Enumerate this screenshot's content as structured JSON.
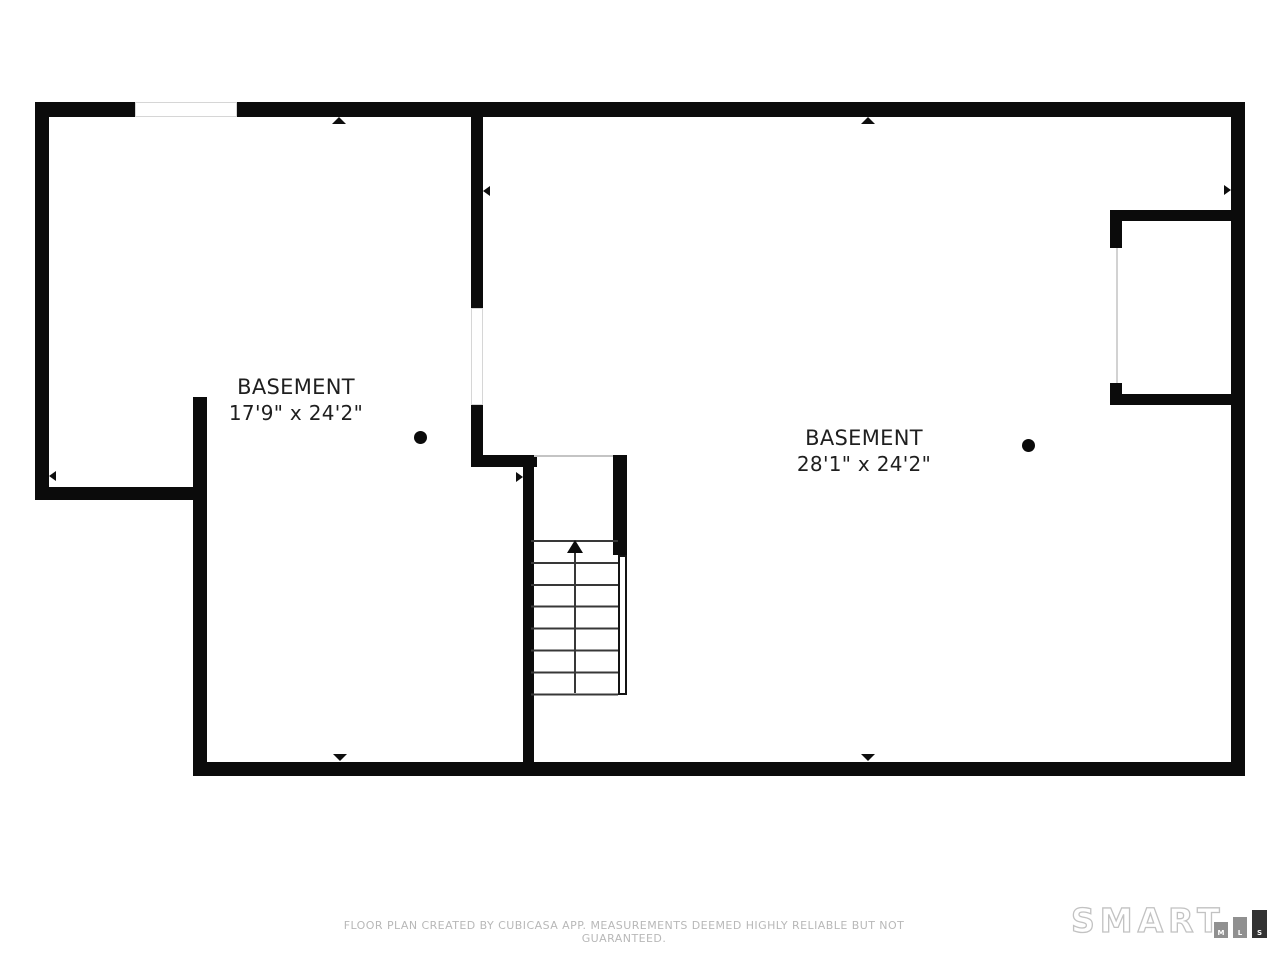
{
  "floor_plan": {
    "type": "basement floor plan",
    "rooms": [
      {
        "name": "BASEMENT",
        "dimensions": "17'9\" x 24'2\""
      },
      {
        "name": "BASEMENT",
        "dimensions": "28'1\" x 24'2\""
      }
    ],
    "stairs": {
      "direction": "up",
      "treads": 7
    },
    "footer_disclaimer": "FLOOR PLAN CREATED BY CUBICASA APP. MEASUREMENTS DEEMED HIGHLY RELIABLE BUT NOT GUARANTEED.",
    "logo": {
      "brand": "SMART",
      "bars": [
        "M",
        "L",
        "S"
      ]
    },
    "colors": {
      "wall": "#0b0b0b",
      "room_text": "#1f1f1f",
      "footer_text": "#b8b8b8",
      "logo_outline": "#c2c2c2",
      "logo_bar_gray": "#909090",
      "logo_bar_dark": "#333333",
      "background": "#ffffff"
    }
  }
}
